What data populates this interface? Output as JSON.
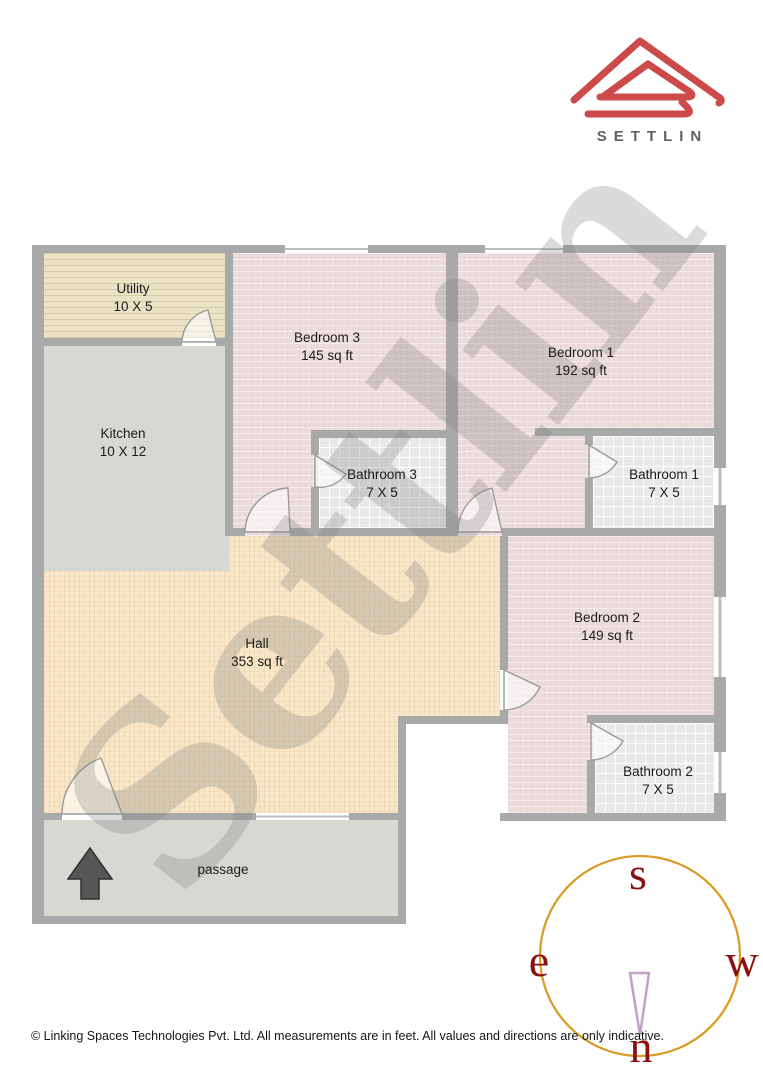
{
  "brand": {
    "logo_text": "SETTLIN",
    "logo_color": "#cd4a4a",
    "logo_text_color": "#606060"
  },
  "watermark": {
    "text": "Settlin"
  },
  "rooms": [
    {
      "id": "utility",
      "name": "Utility",
      "size": "10 X 5"
    },
    {
      "id": "kitchen",
      "name": "Kitchen",
      "size": "10 X 12"
    },
    {
      "id": "bedroom3",
      "name": "Bedroom 3",
      "size": "145 sq ft"
    },
    {
      "id": "bedroom1",
      "name": "Bedroom 1",
      "size": "192 sq ft"
    },
    {
      "id": "bathroom3",
      "name": "Bathroom 3",
      "size": "7 X 5"
    },
    {
      "id": "bathroom1",
      "name": "Bathroom 1",
      "size": "7 X 5"
    },
    {
      "id": "hall",
      "name": "Hall",
      "size": "353 sq ft"
    },
    {
      "id": "bedroom2",
      "name": "Bedroom 2",
      "size": "149 sq ft"
    },
    {
      "id": "bathroom2",
      "name": "Bathroom 2",
      "size": "7 X 5"
    },
    {
      "id": "passage",
      "name": "passage",
      "size": ""
    }
  ],
  "compass": {
    "south": "s",
    "north": "n",
    "east": "e",
    "west": "w",
    "circle_color": "#d79a23",
    "letter_color": "#8b1111",
    "needle_color": "#c59fc7"
  },
  "palette": {
    "wall": "#a9a9a9",
    "bedroom_floor": "#ecdcdc",
    "hall_floor": "#f8e7c9",
    "utility_floor": "#eae3c5",
    "kitchen_passage_floor": "#d6d9d2",
    "bathroom_floor": "#e9e9e9",
    "entrance_arrow": "#565656"
  },
  "footer": {
    "copyright": "© Linking Spaces Technologies Pvt. Ltd. All measurements are in feet. All values and directions are only indicative."
  }
}
